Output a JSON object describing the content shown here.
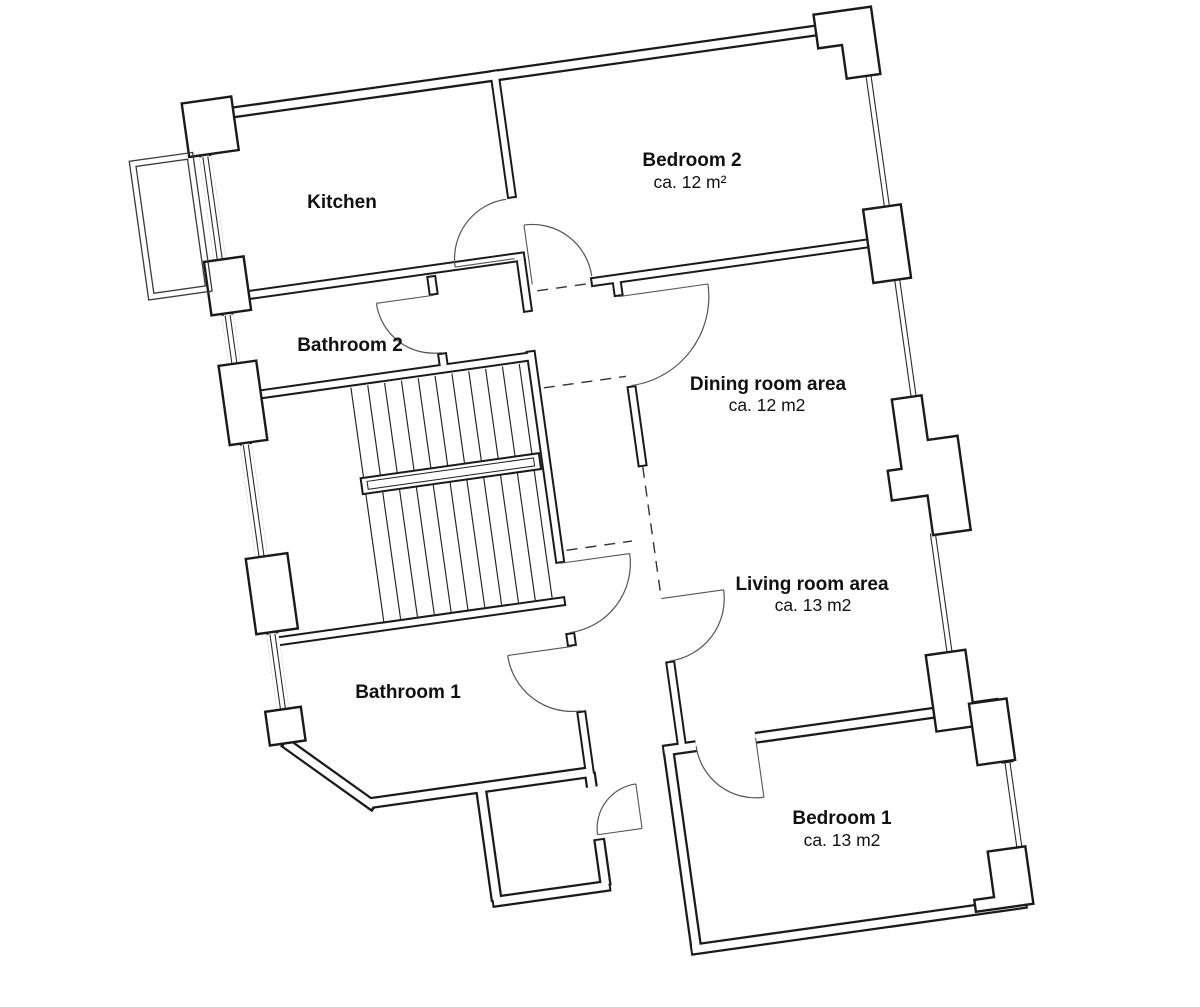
{
  "rooms": [
    {
      "id": "kitchen",
      "name": "Kitchen",
      "area": ""
    },
    {
      "id": "bedroom2",
      "name": "Bedroom 2",
      "area": "ca. 12 m²"
    },
    {
      "id": "bathroom2",
      "name": "Bathroom 2",
      "area": ""
    },
    {
      "id": "dining",
      "name": "Dining room area",
      "area": "ca. 12 m2"
    },
    {
      "id": "living",
      "name": "Living room area",
      "area": "ca. 13 m2"
    },
    {
      "id": "bathroom1",
      "name": "Bathroom 1",
      "area": ""
    },
    {
      "id": "bedroom1",
      "name": "Bedroom 1",
      "area": "ca. 13 m2"
    }
  ]
}
